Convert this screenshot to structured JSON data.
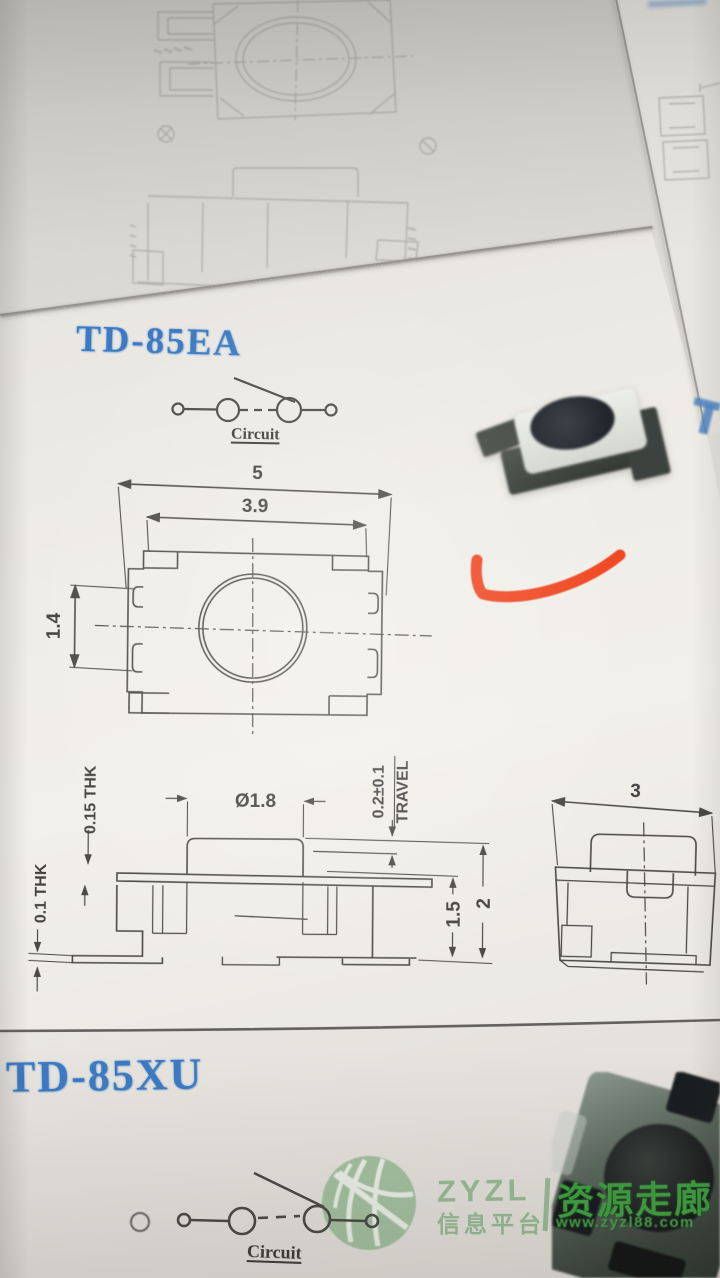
{
  "td85ea": {
    "title": "TD-85EA",
    "circuit_label": "Circuit",
    "top_view": {
      "dim_overall_width": "5",
      "dim_body_width": "3.9",
      "dim_terminal_height": "1.4"
    },
    "front_view": {
      "dim_cover_thickness": "0.15 THK",
      "dim_terminal_thickness": "0.1 THK",
      "dim_stem_diameter": "Ø1.8",
      "dim_travel_value": "0.2±0.1",
      "dim_travel_word": "TRAVEL",
      "dim_height_body": "1.5",
      "dim_height_total": "2"
    },
    "end_view": {
      "dim_depth": "3"
    }
  },
  "td85xu": {
    "title": "TD-85XU",
    "circuit_label": "Circuit"
  },
  "watermark": {
    "brand": "ZYZL",
    "brand_cn": "信息平台",
    "site_name": "资源走廊",
    "site_url": "www.zyzl88.com"
  },
  "colors": {
    "title_blue": "#3b7ac2",
    "ink": "#4a4945",
    "faint_ink": "#97958f",
    "logo_green": "#97ba94",
    "logo_bright_green": "#3f9e41",
    "red_mark": "#ee3c15",
    "paper": "#e8e6e0"
  }
}
